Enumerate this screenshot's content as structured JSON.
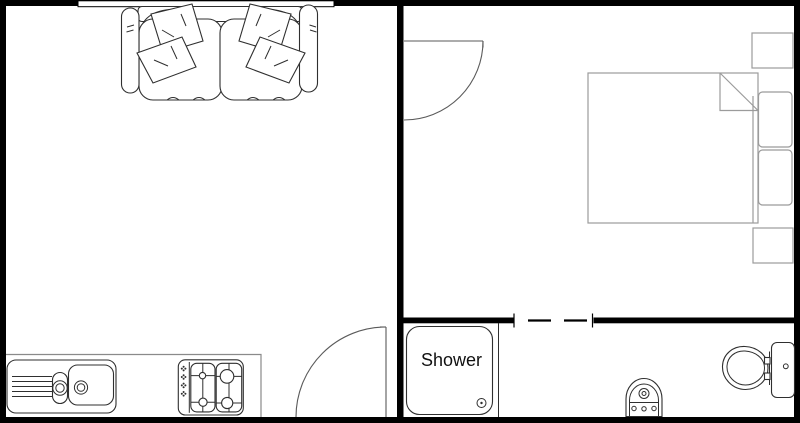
{
  "labels": {
    "shower": "Shower"
  },
  "colors": {
    "background": "#ffffff",
    "wall": "#000000",
    "door": "#5a5a5a",
    "fixture": "#2f2f2f",
    "furniture": "#9b9b9b",
    "counter": "#8a8a8a",
    "text": "#111111"
  },
  "fixtures": {
    "living_room_kitchen": [
      "window",
      "sofa",
      "kitchen-counter",
      "kitchen-sink",
      "gas-hob",
      "entry-door"
    ],
    "bedroom": [
      "bedroom-door",
      "double-bed",
      "bed-pillows",
      "nightstand-top",
      "nightstand-bottom"
    ],
    "bathroom": [
      "dashed-doorway",
      "shower-tray",
      "shower-screen",
      "shower-drain",
      "bidet",
      "toilet"
    ]
  }
}
